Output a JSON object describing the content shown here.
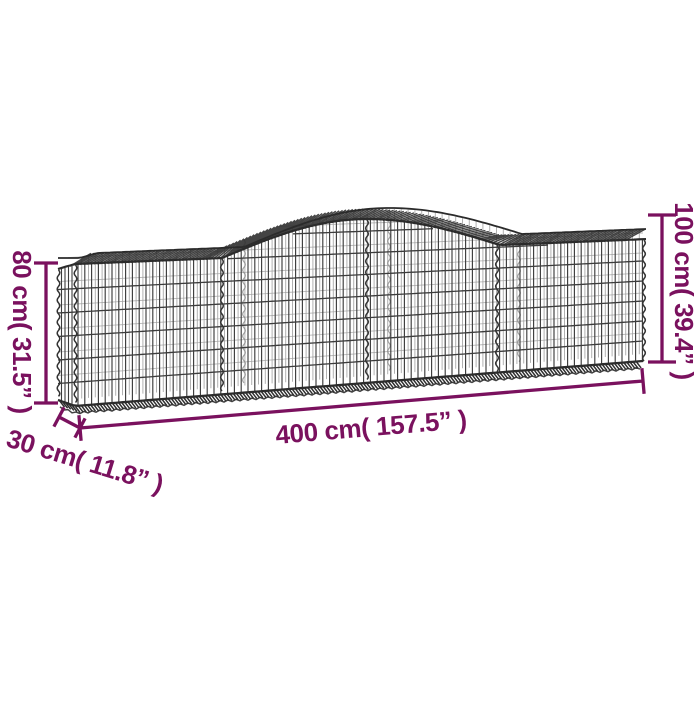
{
  "illustration": {
    "name": "gabion-basket-arched-wireframe",
    "panels": 4,
    "shape": "long wire mesh basket with arched top middle section"
  },
  "dimensions": {
    "height_left": "80 cm( 31.5” )",
    "height_right": "100 cm( 39.4” )",
    "length": "400 cm( 157.5” )",
    "depth": "30 cm( 11.8” )"
  },
  "colors": {
    "accent": "#7A115E",
    "wire_dark": "#3C3C3C",
    "wire_edge": "#2B2B2B",
    "wire_light": "#9B9B9B",
    "background": "#FFFFFF"
  }
}
